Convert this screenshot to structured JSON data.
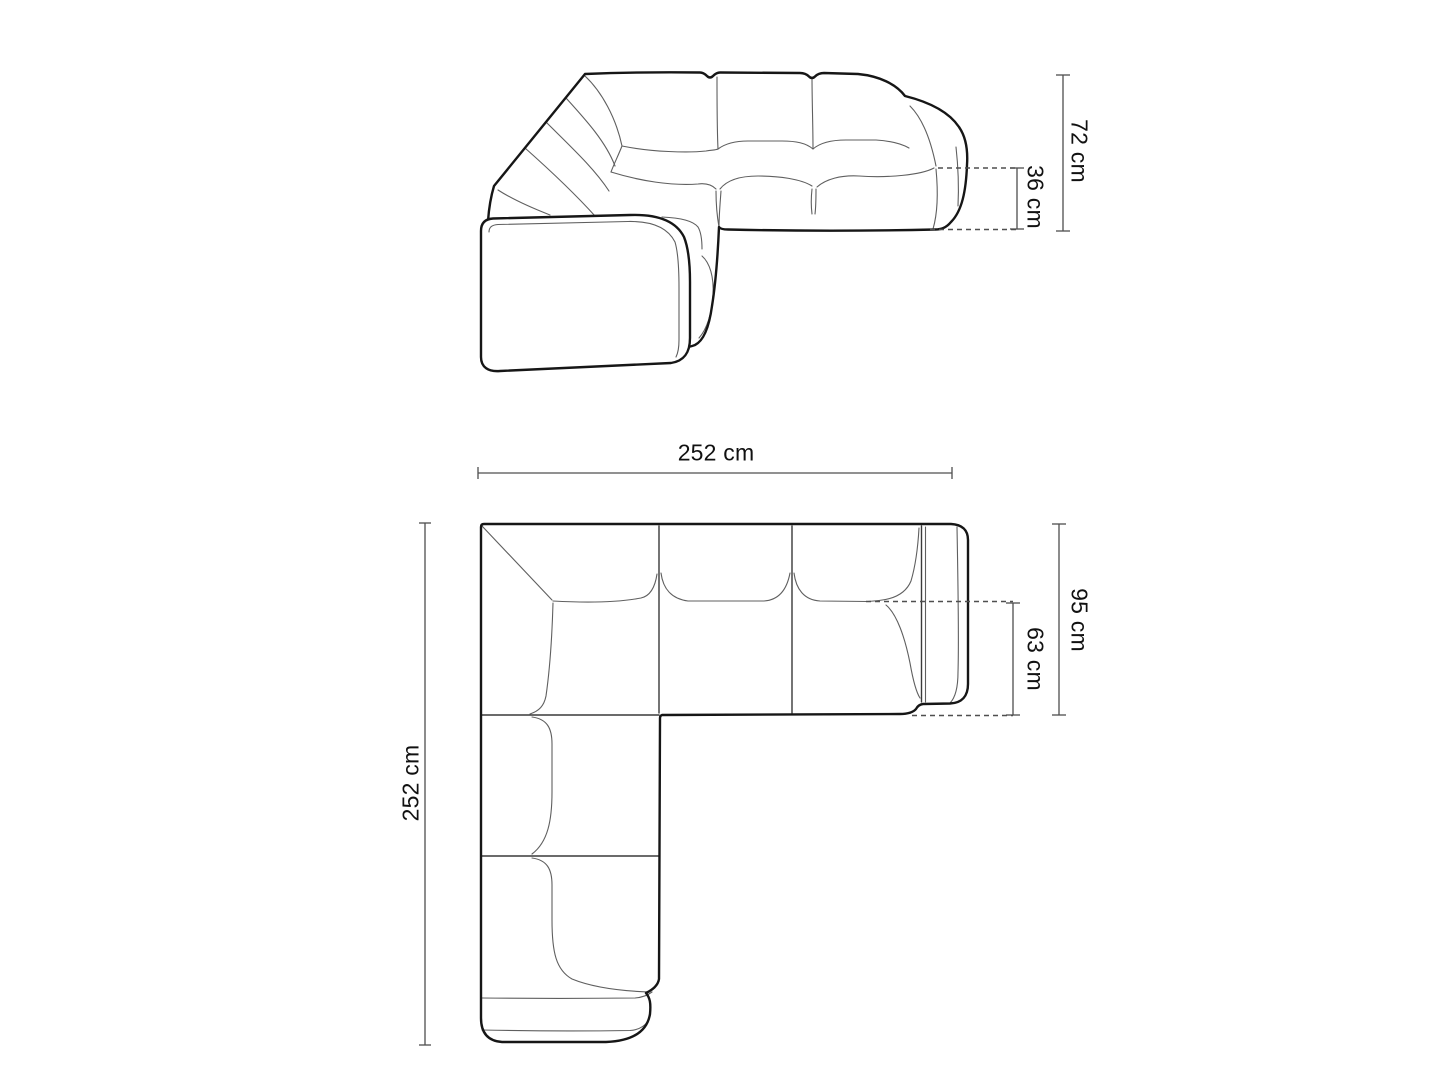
{
  "page": {
    "background_color": "#ffffff"
  },
  "diagram": {
    "subject": "modular corner sofa technical dimension drawing",
    "views": {
      "front": {
        "name": "front elevation"
      },
      "top": {
        "name": "top plan"
      }
    },
    "dimensions": {
      "total_height": {
        "label": "72 cm",
        "value": 72,
        "unit": "cm"
      },
      "seat_height": {
        "label": "36 cm",
        "value": 36,
        "unit": "cm"
      },
      "total_width": {
        "label": "252 cm",
        "value": 252,
        "unit": "cm"
      },
      "total_depth": {
        "label": "252 cm",
        "value": 252,
        "unit": "cm"
      },
      "side_depth": {
        "label": "95 cm",
        "value": 95,
        "unit": "cm"
      },
      "seat_depth": {
        "label": "63 cm",
        "value": 63,
        "unit": "cm"
      }
    },
    "colors": {
      "background": "#ffffff",
      "outline": "#161616",
      "seam": "#5f5f5f",
      "seam_strong": "#3a3a3a",
      "dimension_line": "#4f4f4f",
      "label_text": "#111111"
    }
  }
}
